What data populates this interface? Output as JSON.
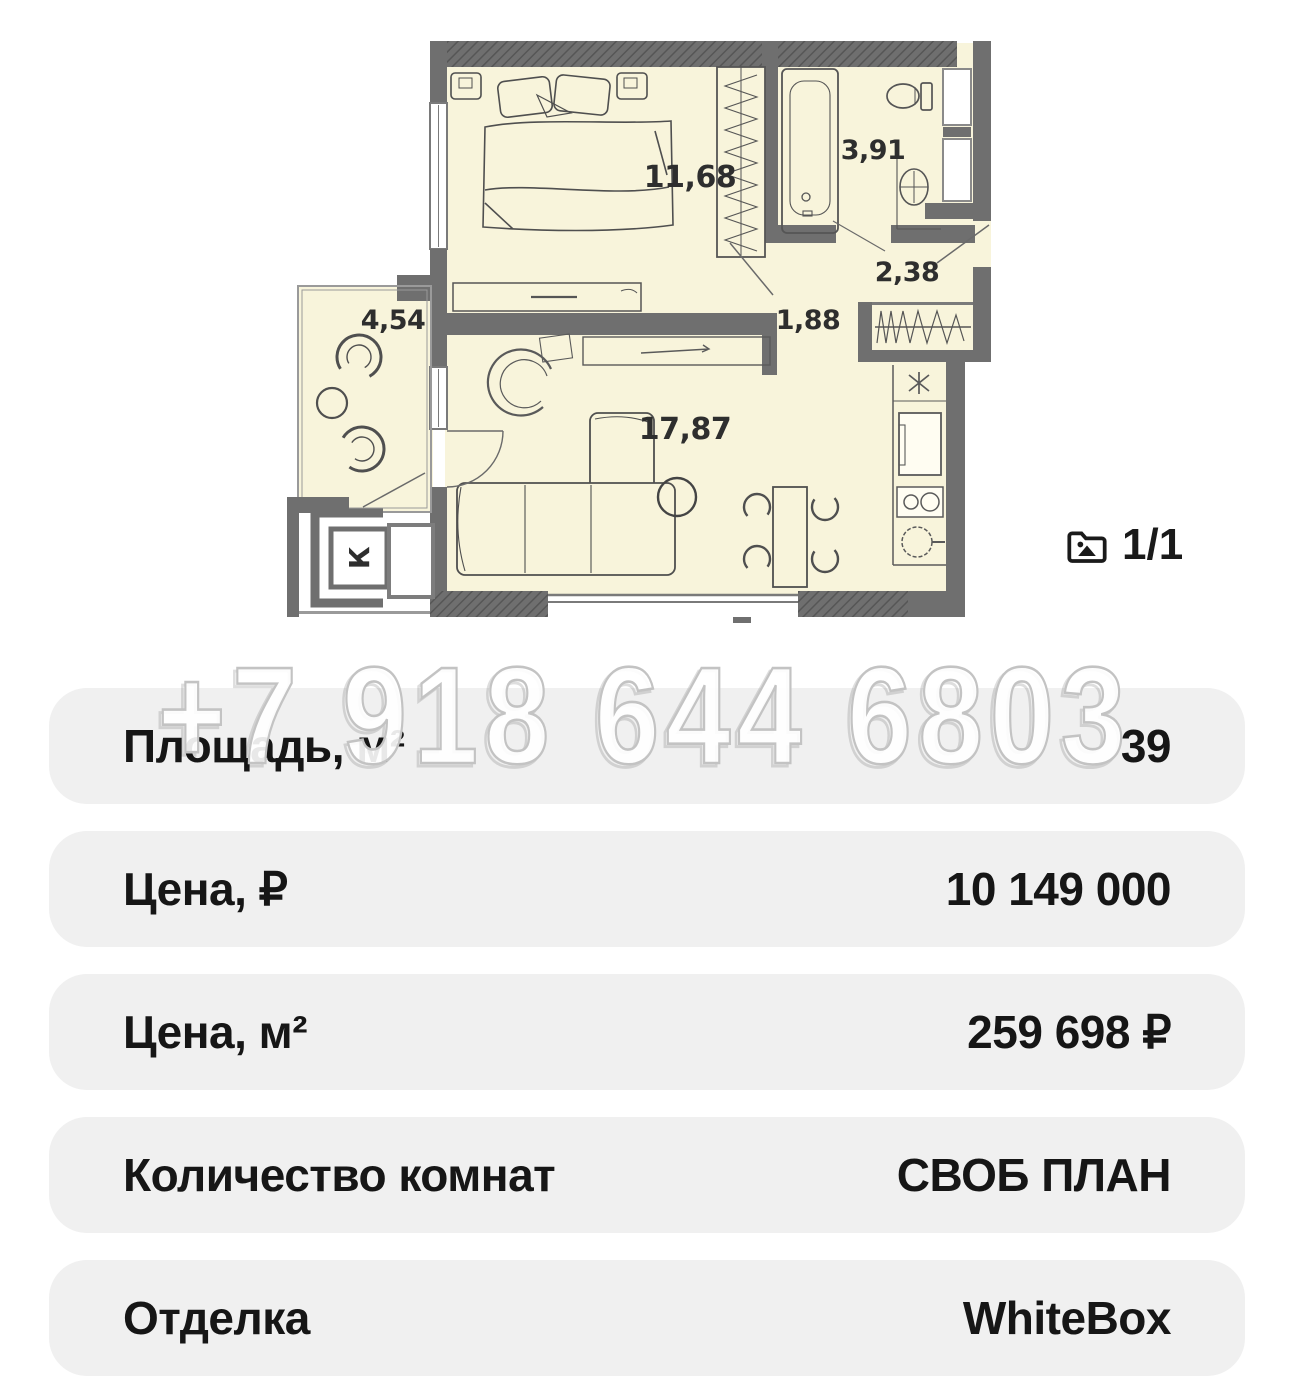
{
  "page": {
    "background": "#ffffff"
  },
  "floor_plan": {
    "colors": {
      "room_fill": "#f8f4db",
      "wall": "#6f6f6f",
      "line": "#4f4f4f"
    },
    "rooms": [
      {
        "id": "bedroom",
        "area": "11,68"
      },
      {
        "id": "bathroom",
        "area": "3,91"
      },
      {
        "id": "entry-hall",
        "area": "2,38"
      },
      {
        "id": "corridor",
        "area": "1,88"
      },
      {
        "id": "living-kitchen",
        "area": "17,87"
      },
      {
        "id": "balcony",
        "area": "4,54"
      }
    ],
    "shaft_label": "К"
  },
  "gallery": {
    "counter": "1/1"
  },
  "watermark": {
    "phone": "+7 918 644 6803"
  },
  "details": {
    "rows": [
      {
        "label": "Площадь, м²",
        "value": "39"
      },
      {
        "label": "Цена, ₽",
        "value": "10 149 000"
      },
      {
        "label": "Цена, м²",
        "value": "259 698 ₽"
      },
      {
        "label": "Количество комнат",
        "value": "СВОБ ПЛАН"
      },
      {
        "label": "Отделка",
        "value": "WhiteBox"
      }
    ]
  }
}
